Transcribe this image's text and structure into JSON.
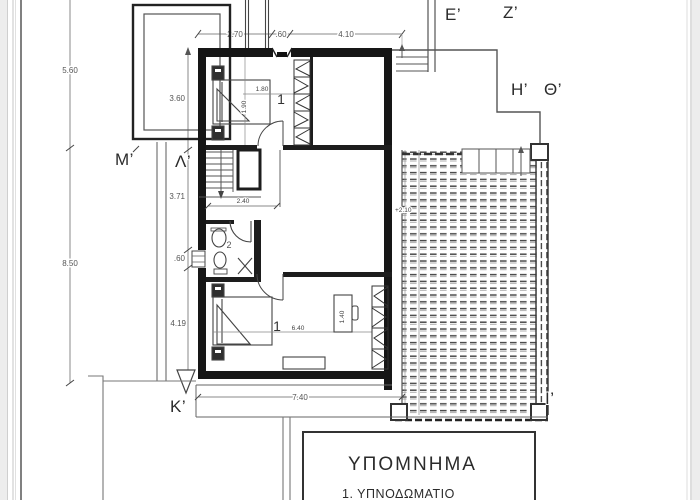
{
  "plan": {
    "section_labels": {
      "E": "E’",
      "Z": "Z’",
      "H": "H’",
      "TH": "Θ’",
      "I": "I’",
      "K": "K’",
      "M": "M’",
      "L": "Λ’"
    },
    "rooms": {
      "bedroom_upper": "1",
      "bedroom_lower": "1",
      "bathroom": "2"
    },
    "dims": {
      "left_upper": "5.60",
      "left_lower": "8.50",
      "v_360": "3.60",
      "v_371": "3.71",
      "v_060": ".60",
      "v_419": "4.19",
      "top_270": "2.70",
      "top_060": ".60",
      "top_410": "4.10",
      "bottom_740": "7.40",
      "stair_240": "2.40",
      "bed_180": "1.80",
      "bed_190": "1.90",
      "room_640": "6.40",
      "desk_140": "1.40",
      "elevation": "+2.10"
    },
    "legend": {
      "title": "ΥΠΟΜΝΗΜΑ",
      "items": [
        "1. ΥΠΝΟΔΩΜΑΤΙΟ"
      ]
    }
  }
}
